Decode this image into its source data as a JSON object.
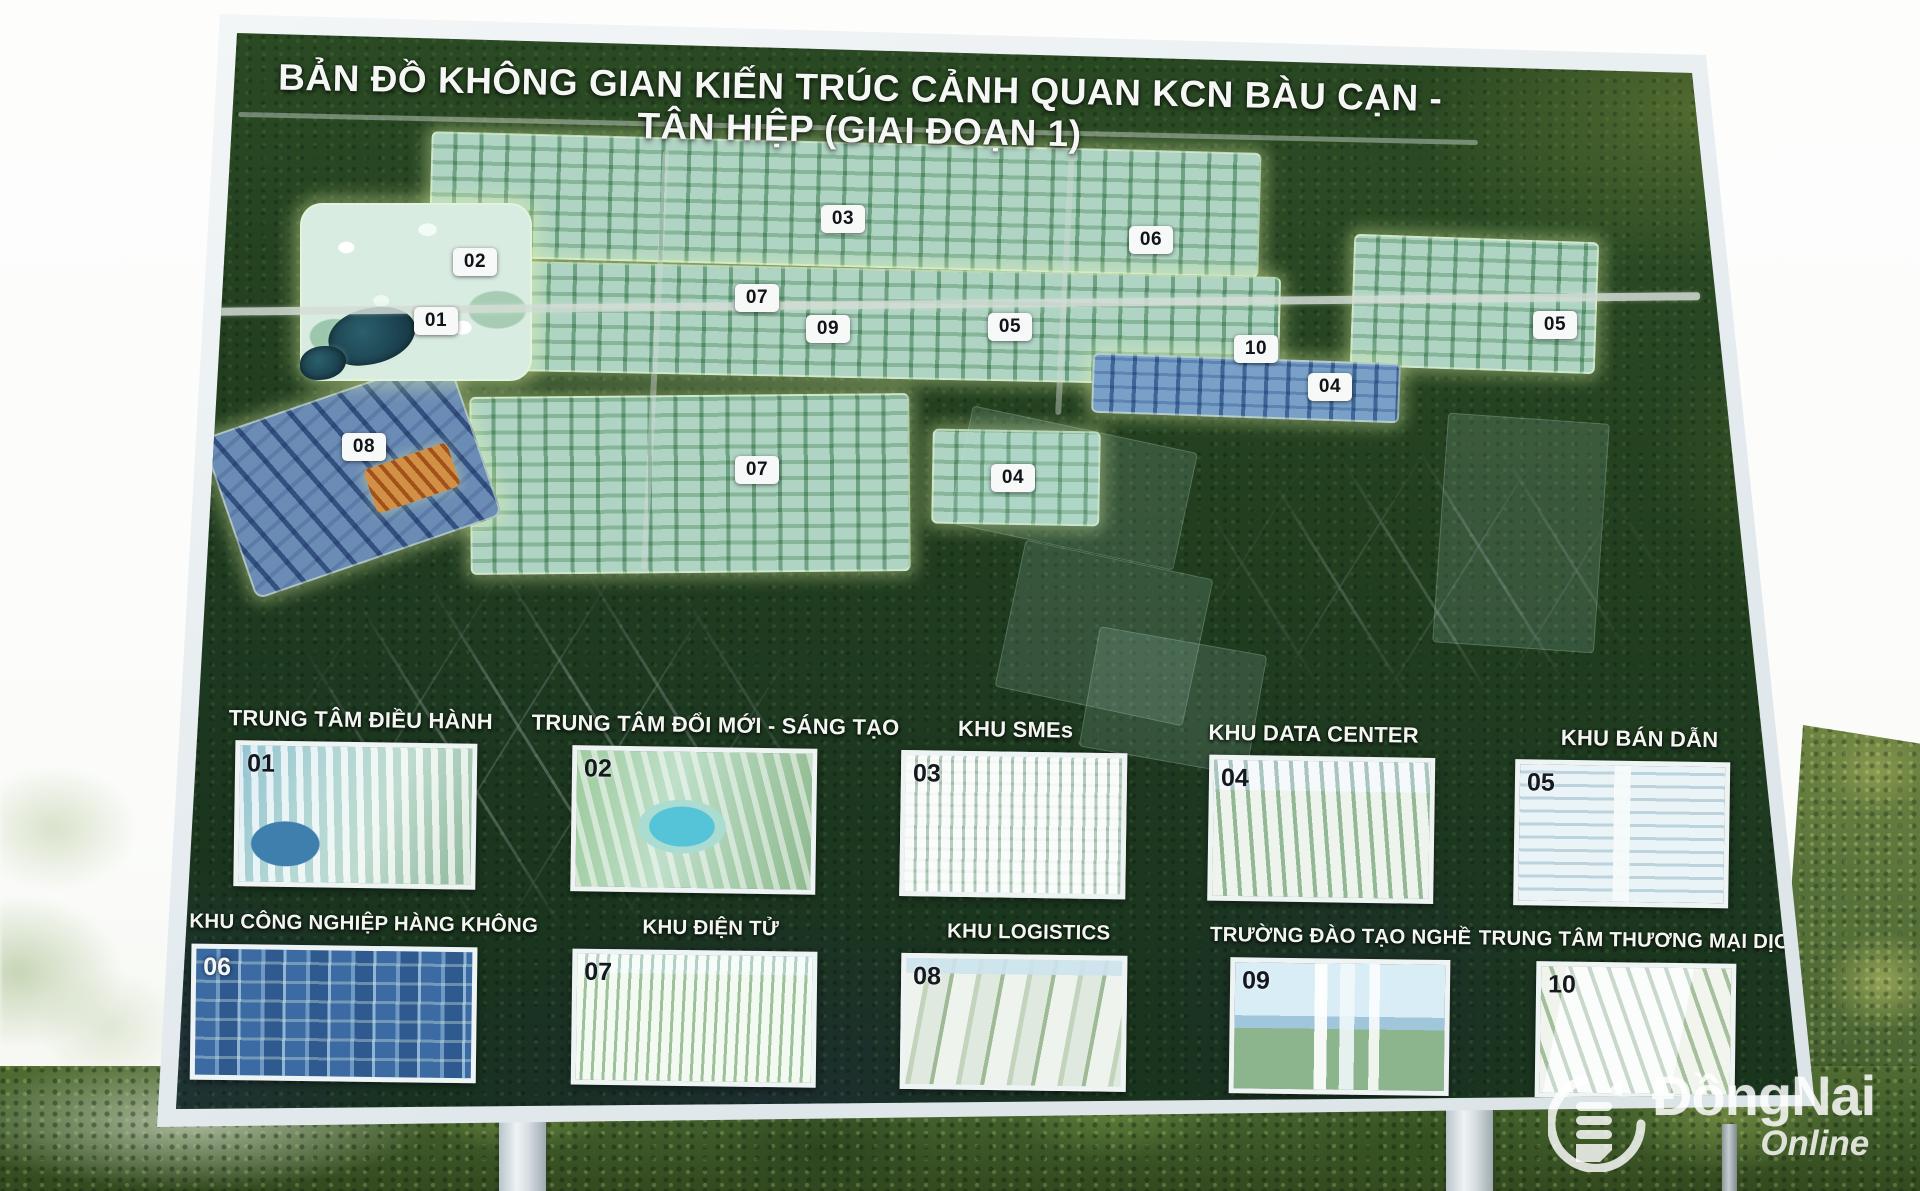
{
  "billboard": {
    "title": "BẢN ĐỒ KHÔNG GIAN KIẾN TRÚC CẢNH QUAN KCN BÀU CẠN - TÂN HIỆP (GIAI ĐOẠN 1)",
    "map": {
      "markers": [
        {
          "num": "01",
          "x": 436,
          "y": 321
        },
        {
          "num": "02",
          "x": 475,
          "y": 262
        },
        {
          "num": "03",
          "x": 843,
          "y": 219
        },
        {
          "num": "04",
          "x": 1330,
          "y": 387
        },
        {
          "num": "04",
          "x": 1013,
          "y": 478
        },
        {
          "num": "05",
          "x": 1010,
          "y": 327
        },
        {
          "num": "05",
          "x": 1555,
          "y": 325
        },
        {
          "num": "06",
          "x": 1151,
          "y": 240
        },
        {
          "num": "07",
          "x": 757,
          "y": 298
        },
        {
          "num": "07",
          "x": 757,
          "y": 470
        },
        {
          "num": "08",
          "x": 364,
          "y": 447
        },
        {
          "num": "09",
          "x": 828,
          "y": 329
        },
        {
          "num": "10",
          "x": 1256,
          "y": 349
        }
      ]
    },
    "legend_row1": [
      {
        "num": "01",
        "label": "TRUNG TÂM ĐIỀU HÀNH"
      },
      {
        "num": "02",
        "label": "TRUNG TÂM ĐỔI MỚI - SÁNG TẠO"
      },
      {
        "num": "03",
        "label": "KHU SMEs"
      },
      {
        "num": "04",
        "label": "KHU DATA CENTER"
      },
      {
        "num": "05",
        "label": "KHU BÁN DẪN"
      }
    ],
    "legend_row2": [
      {
        "num": "06",
        "label": "KHU CÔNG NGHIỆP HÀNG KHÔNG"
      },
      {
        "num": "07",
        "label": "KHU ĐIỆN TỬ"
      },
      {
        "num": "08",
        "label": "KHU LOGISTICS"
      },
      {
        "num": "09",
        "label": "TRƯỜNG ĐÀO TẠO NGHỀ"
      },
      {
        "num": "10",
        "label": "TRUNG TÂM THƯƠNG MẠI DỊCH VỤ"
      }
    ],
    "colors": {
      "frame": "#eef2f4",
      "forest_dark": "#1d3820",
      "park_light": "#d6eae0",
      "boundary_glow": "#e8f8aa",
      "badge_bg": "#f7f9f8",
      "badge_text": "#101418",
      "title_text": "#f4f7f3"
    }
  },
  "watermark": {
    "brand": "ĐồngNai",
    "suffix": "Online"
  }
}
